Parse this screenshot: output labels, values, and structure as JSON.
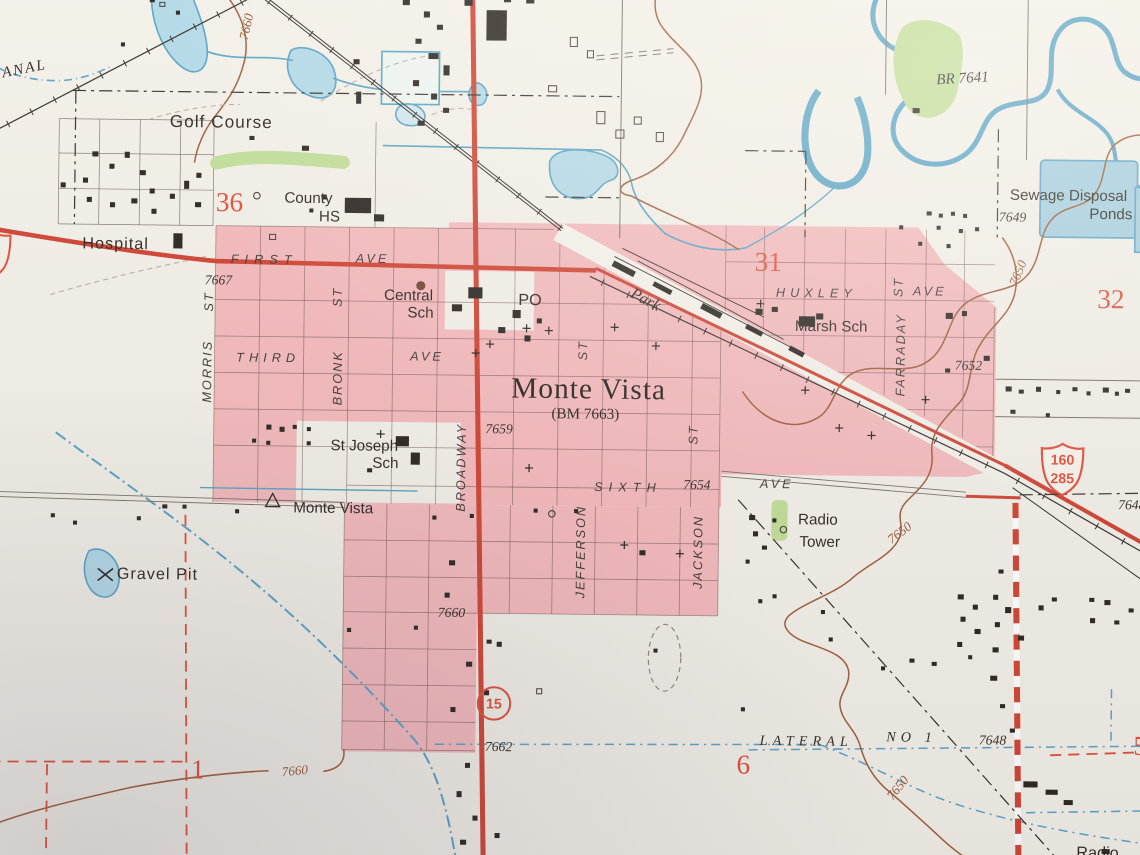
{
  "photo": {
    "description": "Photograph of a USGS topographic quadrangle paper map showing the town of Monte Vista"
  },
  "colors": {
    "paper": "#f2efe7",
    "urban_tint": "#f3b6b9",
    "road_red": "#cd3a28",
    "section_red": "#e0462f",
    "water_line": "#4f9fc4",
    "water_fill": "#aed7e6",
    "contour_brown": "#8f4f2e",
    "vegetation_green": "#bddc92",
    "ink": "#27211b"
  },
  "shields": {
    "us_top": "160",
    "us_bottom": "285",
    "route15": "15"
  },
  "labels": [
    {
      "id": "canal-name",
      "t": "ANAL",
      "x": 27,
      "y": 80,
      "rot": -12,
      "cls": "water",
      "s": 15,
      "ls": 2
    },
    {
      "id": "contour-7660-nw",
      "t": "7660",
      "x": 246,
      "y": 35,
      "rot": -78,
      "cls": "contour"
    },
    {
      "id": "golf-course",
      "t": "Golf Course",
      "x": 222,
      "y": 130,
      "cls": "place",
      "s": 17,
      "ls": 1
    },
    {
      "id": "sec-36",
      "t": "36",
      "x": 231,
      "y": 209,
      "cls": "section"
    },
    {
      "id": "county-hs-line1",
      "t": "County",
      "x": 309,
      "y": 204,
      "cls": "place",
      "s": 15
    },
    {
      "id": "county-hs-line2",
      "t": "HS",
      "x": 330,
      "y": 222,
      "cls": "place",
      "s": 15
    },
    {
      "id": "hospital",
      "t": "Hospital",
      "x": 119,
      "y": 252,
      "cls": "place",
      "s": 16,
      "ls": 1
    },
    {
      "id": "first-st-name",
      "t": "FIRST",
      "x": 266,
      "y": 265,
      "cls": "street",
      "ls": 6
    },
    {
      "id": "first-ave-suffix",
      "t": "AVE",
      "x": 373,
      "y": 263,
      "cls": "street",
      "ls": 3
    },
    {
      "id": "elev-7667",
      "t": "7667",
      "x": 221,
      "y": 286,
      "cls": "elev"
    },
    {
      "id": "morris-st-suffix",
      "t": "ST",
      "x": 212,
      "y": 307,
      "rot": -90,
      "cls": "street"
    },
    {
      "id": "morris-st",
      "t": "MORRIS",
      "x": 211,
      "y": 376,
      "rot": -90,
      "cls": "street"
    },
    {
      "id": "bronk-st-suffix",
      "t": "ST",
      "x": 339,
      "y": 301,
      "rot": -90,
      "cls": "street"
    },
    {
      "id": "bronk-st",
      "t": "BRONK",
      "x": 340,
      "y": 381,
      "rot": -90,
      "cls": "street"
    },
    {
      "id": "third-st-name",
      "t": "THIRD",
      "x": 271,
      "y": 362,
      "cls": "street",
      "ls": 5
    },
    {
      "id": "third-ave-suffix",
      "t": "AVE",
      "x": 428,
      "y": 359,
      "cls": "street",
      "ls": 3
    },
    {
      "id": "central-sch-line1",
      "t": "Central",
      "x": 409,
      "y": 299,
      "cls": "place",
      "s": 15
    },
    {
      "id": "central-sch-line2",
      "t": "Sch",
      "x": 421,
      "y": 316,
      "cls": "place",
      "s": 15
    },
    {
      "id": "po",
      "t": "PO",
      "x": 529,
      "y": 303,
      "cls": "place",
      "s": 16
    },
    {
      "id": "park",
      "t": "Park",
      "x": 643,
      "y": 301,
      "rot": 27,
      "cls": "water",
      "s": 16
    },
    {
      "id": "huxley-ave-name",
      "t": "HUXLEY",
      "x": 812,
      "y": 292,
      "cls": "street",
      "ls": 5
    },
    {
      "id": "huxley-ave-suffix",
      "t": "AVE",
      "x": 924,
      "y": 289,
      "cls": "street",
      "ls": 3
    },
    {
      "id": "marsh-sch",
      "t": "Marsh Sch",
      "x": 827,
      "y": 325,
      "cls": "place",
      "s": 15
    },
    {
      "id": "farraday-st-suffix",
      "t": "ST",
      "x": 893,
      "y": 285,
      "rot": -90,
      "cls": "street"
    },
    {
      "id": "farraday-st",
      "t": "FARRADAY",
      "x": 896,
      "y": 352,
      "rot": -90,
      "cls": "street"
    },
    {
      "id": "elev-7652",
      "t": "7652",
      "x": 963,
      "y": 362,
      "cls": "elev"
    },
    {
      "id": "sec-31",
      "t": "31",
      "x": 764,
      "y": 262,
      "cls": "section"
    },
    {
      "id": "sec-32",
      "t": "32",
      "x": 1103,
      "y": 295,
      "cls": "section"
    },
    {
      "id": "contour-7650-ne",
      "t": "7650",
      "x": 1011,
      "y": 270,
      "rot": -68,
      "cls": "contour"
    },
    {
      "id": "elev-7649",
      "t": "7649",
      "x": 1005,
      "y": 215,
      "cls": "elev"
    },
    {
      "id": "sewage-line1",
      "t": "Sewage Disposal",
      "x": 1060,
      "y": 193,
      "cls": "place",
      "s": 15
    },
    {
      "id": "sewage-line2",
      "t": "Ponds",
      "x": 1102,
      "y": 211,
      "cls": "place",
      "s": 15
    },
    {
      "id": "br-7641",
      "t": "BR 7641",
      "x": 954,
      "y": 79,
      "rot": -4,
      "cls": "water",
      "s": 15
    },
    {
      "id": "town-name",
      "t": "Monte Vista",
      "x": 588,
      "y": 390,
      "cls": "town"
    },
    {
      "id": "bm-7663",
      "t": "(BM 7663)",
      "x": 585,
      "y": 415,
      "cls": "town-sub"
    },
    {
      "id": "broadway",
      "t": "BROADWAY",
      "x": 463,
      "y": 468,
      "rot": -90,
      "cls": "street"
    },
    {
      "id": "elev-7659",
      "t": "7659",
      "x": 500,
      "y": 430,
      "cls": "elev"
    },
    {
      "id": "st-frag-n",
      "t": "ST",
      "x": 582,
      "y": 351,
      "rot": -90,
      "cls": "street"
    },
    {
      "id": "st-joseph-line1",
      "t": "St Joseph",
      "x": 367,
      "y": 448,
      "cls": "place",
      "s": 15
    },
    {
      "id": "st-joseph-line2",
      "t": "Sch",
      "x": 388,
      "y": 465,
      "cls": "place",
      "s": 15
    },
    {
      "id": "mv-station",
      "t": "Monte Vista",
      "x": 337,
      "y": 510,
      "cls": "place",
      "s": 15
    },
    {
      "id": "sixth-ave-name",
      "t": "SIXTH",
      "x": 628,
      "y": 486,
      "cls": "street",
      "ls": 6
    },
    {
      "id": "elev-7654",
      "t": "7654",
      "x": 696,
      "y": 483,
      "cls": "elev"
    },
    {
      "id": "sixth-ave-suffix",
      "t": "AVE",
      "x": 775,
      "y": 481,
      "cls": "street",
      "ls": 3
    },
    {
      "id": "jefferson-st",
      "t": "JEFFERSON",
      "x": 582,
      "y": 550,
      "rot": -90,
      "cls": "street"
    },
    {
      "id": "jackson-st",
      "t": "JACKSON",
      "x": 698,
      "y": 549,
      "rot": -90,
      "cls": "street"
    },
    {
      "id": "st-frag-s",
      "t": "ST",
      "x": 692,
      "y": 433,
      "rot": -90,
      "cls": "street"
    },
    {
      "id": "radio-tower-line1",
      "t": "Radio",
      "x": 816,
      "y": 516,
      "cls": "place",
      "s": 15
    },
    {
      "id": "radio-tower-line2",
      "t": "Tower",
      "x": 818,
      "y": 538,
      "cls": "place",
      "s": 15
    },
    {
      "id": "contour-7650-mid",
      "t": "7650",
      "x": 897,
      "y": 528,
      "rot": -38,
      "cls": "contour"
    },
    {
      "id": "gravel-pit",
      "t": "Gravel Pit",
      "x": 164,
      "y": 578,
      "cls": "place",
      "s": 16,
      "ls": 1
    },
    {
      "id": "elev-7660-mid",
      "t": "7660",
      "x": 455,
      "y": 612,
      "cls": "elev"
    },
    {
      "id": "elev-7662",
      "t": "7662",
      "x": 503,
      "y": 744,
      "cls": "elev"
    },
    {
      "id": "sec-1",
      "t": "1",
      "x": 206,
      "y": 770,
      "cls": "section"
    },
    {
      "id": "contour-7660-sw",
      "t": "7660",
      "x": 302,
      "y": 770,
      "rot": -6,
      "cls": "contour"
    },
    {
      "id": "sec-6",
      "t": "6",
      "x": 745,
      "y": 759,
      "cls": "section"
    },
    {
      "id": "lateral-line1",
      "t": "LATERAL",
      "x": 807,
      "y": 736,
      "cls": "water-caps"
    },
    {
      "id": "lateral-line2",
      "t": "NO 1",
      "x": 911,
      "y": 731,
      "cls": "water-caps"
    },
    {
      "id": "elev-7648-a",
      "t": "7648",
      "x": 991,
      "y": 732,
      "cls": "elev"
    },
    {
      "id": "contour-7650-s",
      "t": "7650",
      "x": 898,
      "y": 780,
      "rot": -52,
      "cls": "contour"
    },
    {
      "id": "elev-7648-b",
      "t": "7648",
      "x": 1126,
      "y": 498,
      "cls": "elev"
    },
    {
      "id": "sec-5",
      "t": "5",
      "x": 1137,
      "y": 736,
      "cls": "section"
    },
    {
      "id": "radio-se",
      "t": "Radio",
      "x": 1096,
      "y": 843,
      "cls": "place",
      "s": 16
    }
  ]
}
